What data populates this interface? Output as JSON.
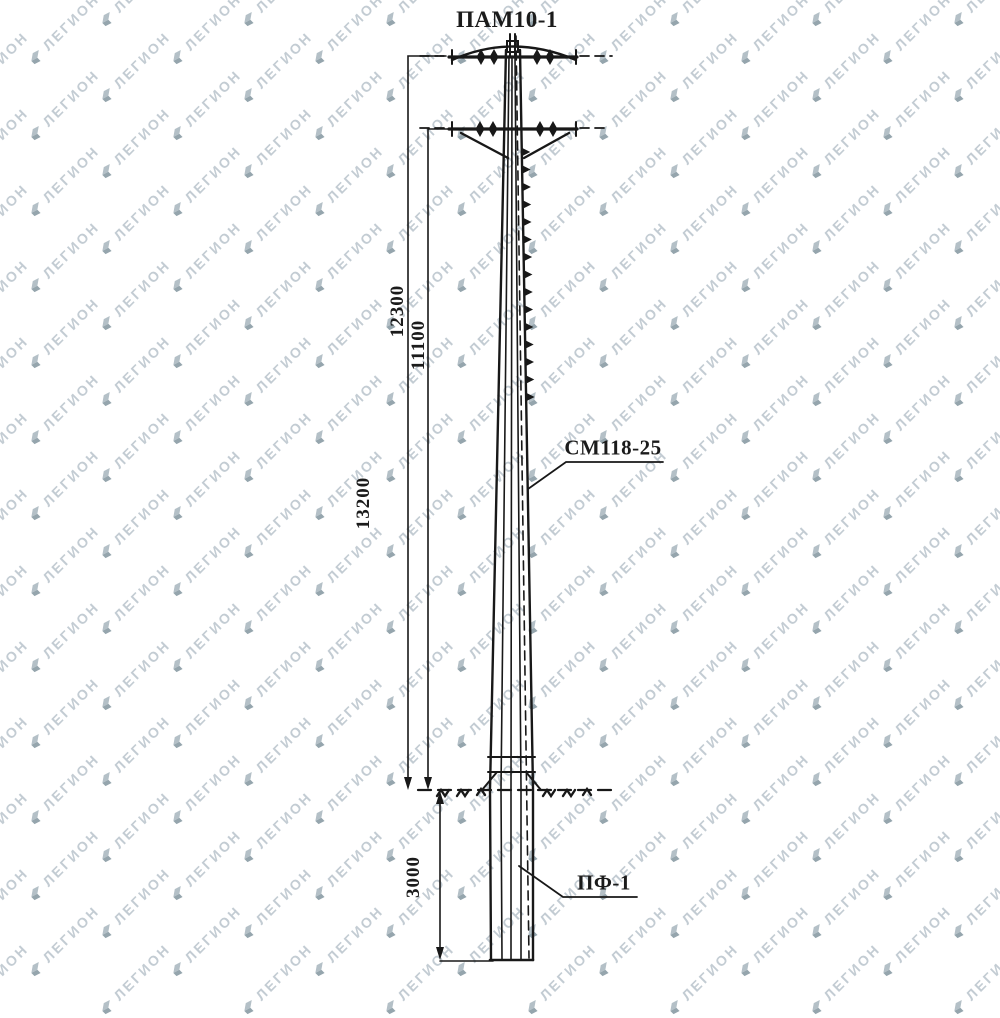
{
  "watermark": {
    "text": "ЛЕГИОН",
    "colors": {
      "text": "#c3ccd3",
      "icon_light": "#b4c0c7",
      "icon_dark": "#95a5ad"
    }
  },
  "drawing": {
    "labels": {
      "top_assembly": "ПАМ10-1",
      "pole_model": "СМ118-25",
      "foundation": "ПФ-1"
    },
    "dimensions": {
      "top_crossarm": "12300",
      "lower_crossarm": "11100",
      "overall": "13200",
      "embedment": "3000"
    },
    "colors": {
      "ink": "#181818",
      "background": "#ffffff"
    }
  }
}
